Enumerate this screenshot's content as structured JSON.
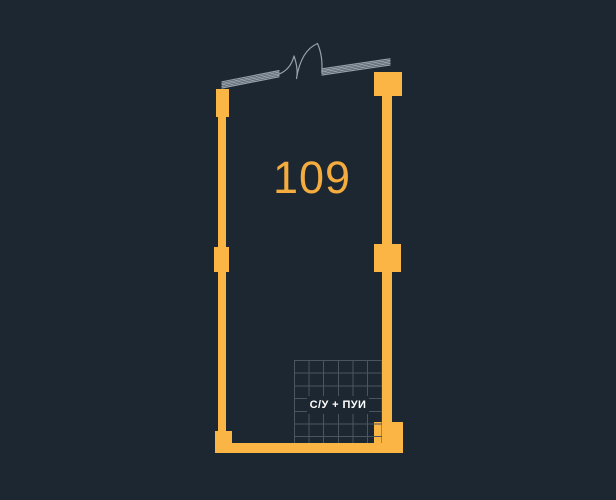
{
  "plan": {
    "room_number": "109",
    "bath_label": "С/У + ПУИ",
    "elements": {
      "door": "double-leaf-door-swing",
      "window_left": "window-hatch",
      "window_right": "window-hatch",
      "tiled_area": "bathroom-tiles"
    },
    "colors": {
      "background": "#1D2731",
      "wall": "#FBB544",
      "room_number_text": "#F5AC3E",
      "hatch_line": "#97A1AC",
      "tile_line": "#4A5560",
      "label_text": "#FFFFFF"
    }
  }
}
